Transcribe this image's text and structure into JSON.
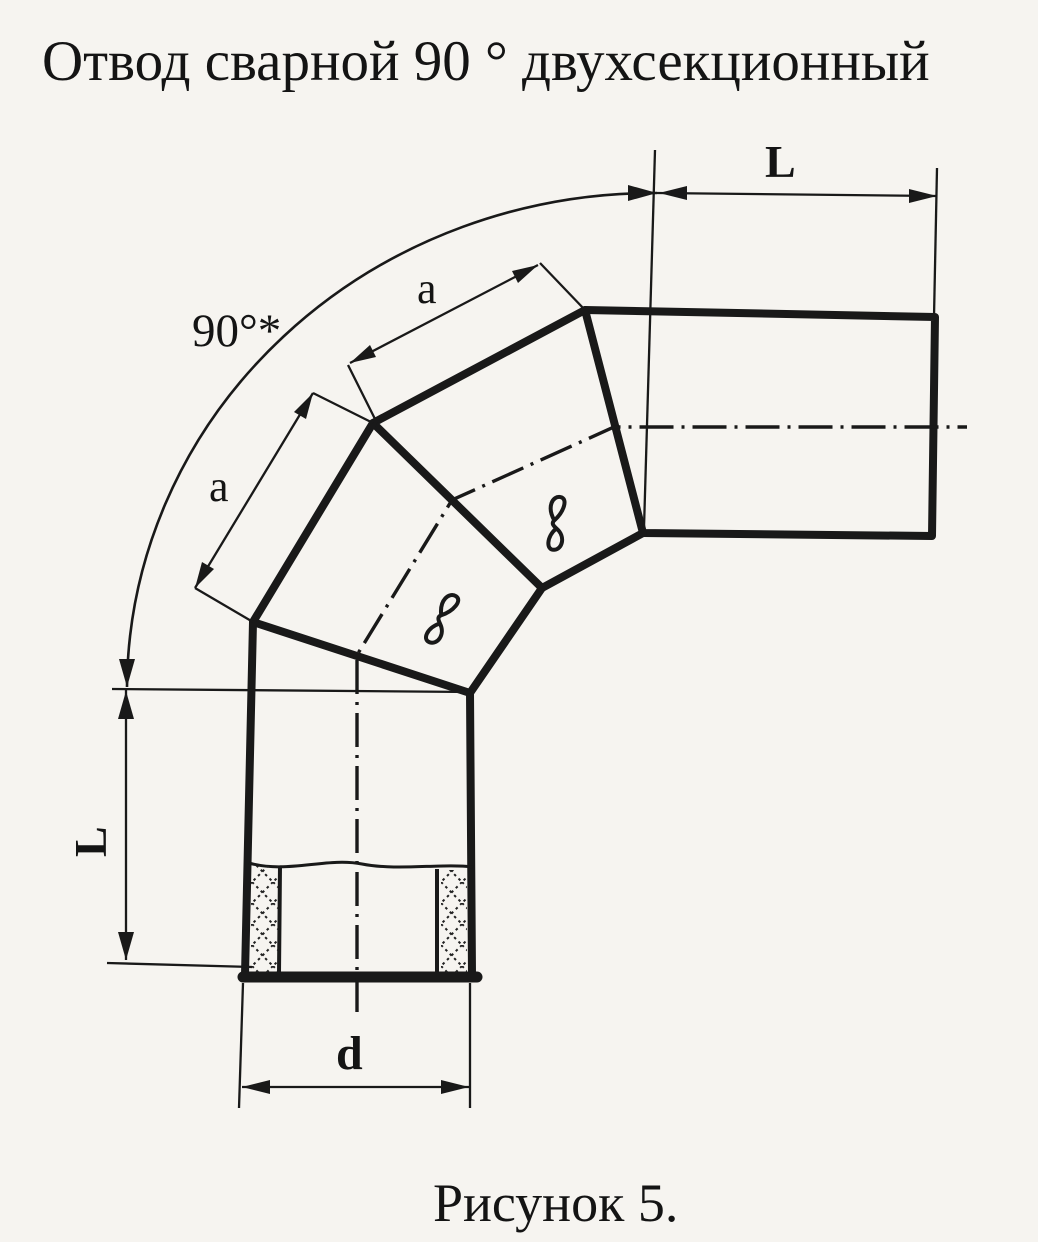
{
  "page": {
    "title": "Отвод сварной 90 ° двухсекционный",
    "caption": "Рисунок 5."
  },
  "drawing": {
    "description": "Welded 90 degree two-section pipe elbow, dimensioned outline drawing",
    "labels": {
      "angle": "90°*",
      "leg_top": "L",
      "leg_left": "L",
      "section_upper": "a",
      "section_lower": "a",
      "diameter": "d"
    },
    "weld_marks": {
      "upper": "в",
      "lower": "в"
    },
    "colors": {
      "ink": "#191919",
      "paper": "#f6f4f0"
    }
  }
}
